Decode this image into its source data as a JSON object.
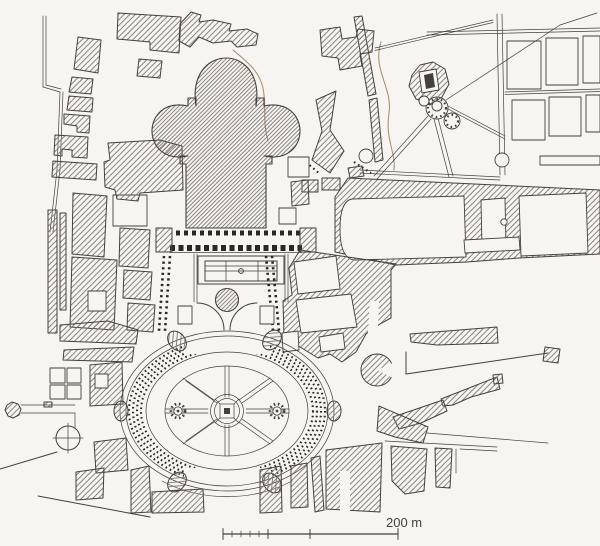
{
  "map": {
    "scale_label": "200 m"
  },
  "colors": {
    "paper": "#f7f5f1",
    "ink": "#45403a",
    "hatch": "#7d7770",
    "hatch_dense": "#6e6862",
    "contour": "#ab9170",
    "dots": "#2b2724"
  }
}
